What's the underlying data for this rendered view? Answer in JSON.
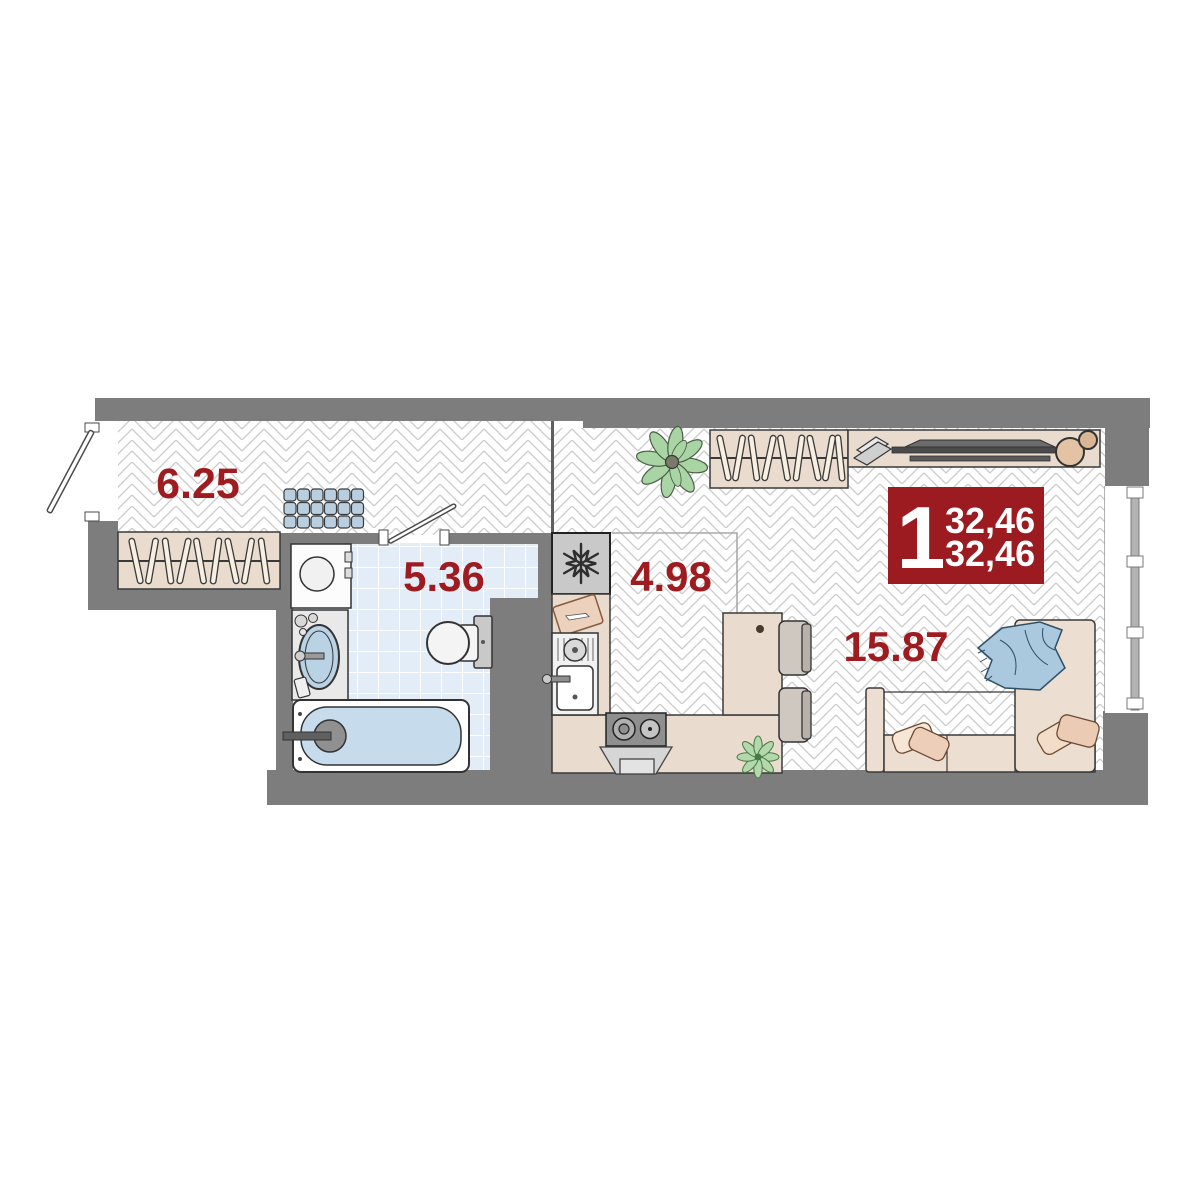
{
  "badge": {
    "rooms_count": "1",
    "area_top": "32,46",
    "area_bottom": "32,46",
    "bg_color": "#9b1b20",
    "text_color": "#ffffff"
  },
  "rooms": {
    "hallway": {
      "label": "6.25"
    },
    "bathroom": {
      "label": "5.36"
    },
    "kitchen": {
      "label": "4.98"
    },
    "living_room": {
      "label": "15.87"
    }
  },
  "colors": {
    "wall": "#7d7d7d",
    "room_label_red": "#9e1b20",
    "floor_line": "#cccccc",
    "tile_fill": "#e2edf7",
    "furniture_beige": "#e9dccf",
    "water_blue": "#c6dcec",
    "blanket_blue": "#aac8de",
    "plant_green": "#a9d4a4"
  }
}
